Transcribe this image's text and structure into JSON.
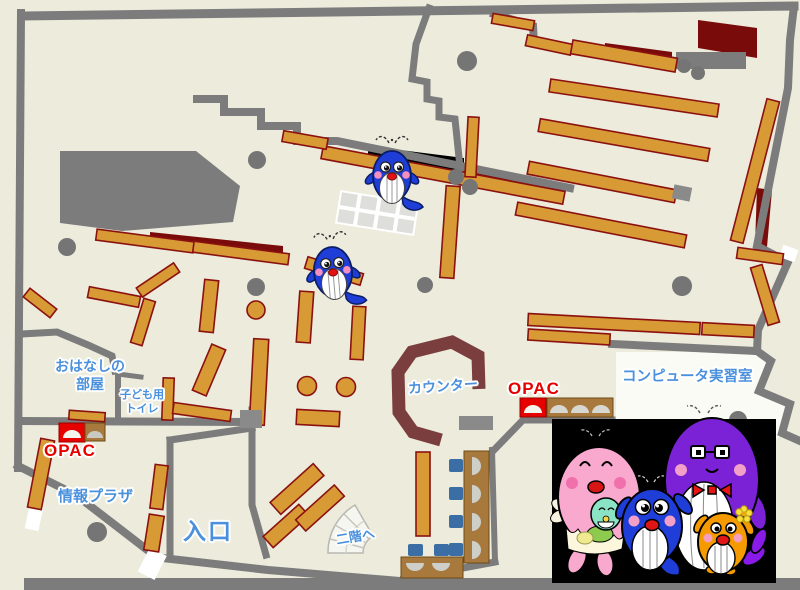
{
  "map_type": "library-floor-map",
  "labels": {
    "storytelling_room": "おはなしの\n部屋",
    "kids_toilet": "子ども用\nトイレ",
    "opac_left": "OPAC",
    "info_plaza": "情報プラザ",
    "entrance": "入口",
    "counter": "カウンター",
    "opac_right": "OPAC",
    "computer_room": "コンピュータ実習室",
    "to_second_floor": "二階へ"
  },
  "colors": {
    "background": "#ECEBDC",
    "wall": "#7C7C7C",
    "shelf": "#D79A35",
    "shelf_border": "#8B1111",
    "counter": "#7B3E3E",
    "accent_dark_red": "#7A0B0B",
    "label_blue": "#4A90DC",
    "opac_red": "#E60000",
    "chair_blue": "#3A6EA5",
    "desk_brown": "#A8793C",
    "mascot_panel": "#000000"
  },
  "icons": {
    "map_markers": [
      "blue-whale-mascot",
      "blue-whale-mascot"
    ],
    "mascot_family": [
      "pink-mother-whale",
      "purple-father-whale",
      "blue-child-whale",
      "orange-child-whale"
    ]
  }
}
